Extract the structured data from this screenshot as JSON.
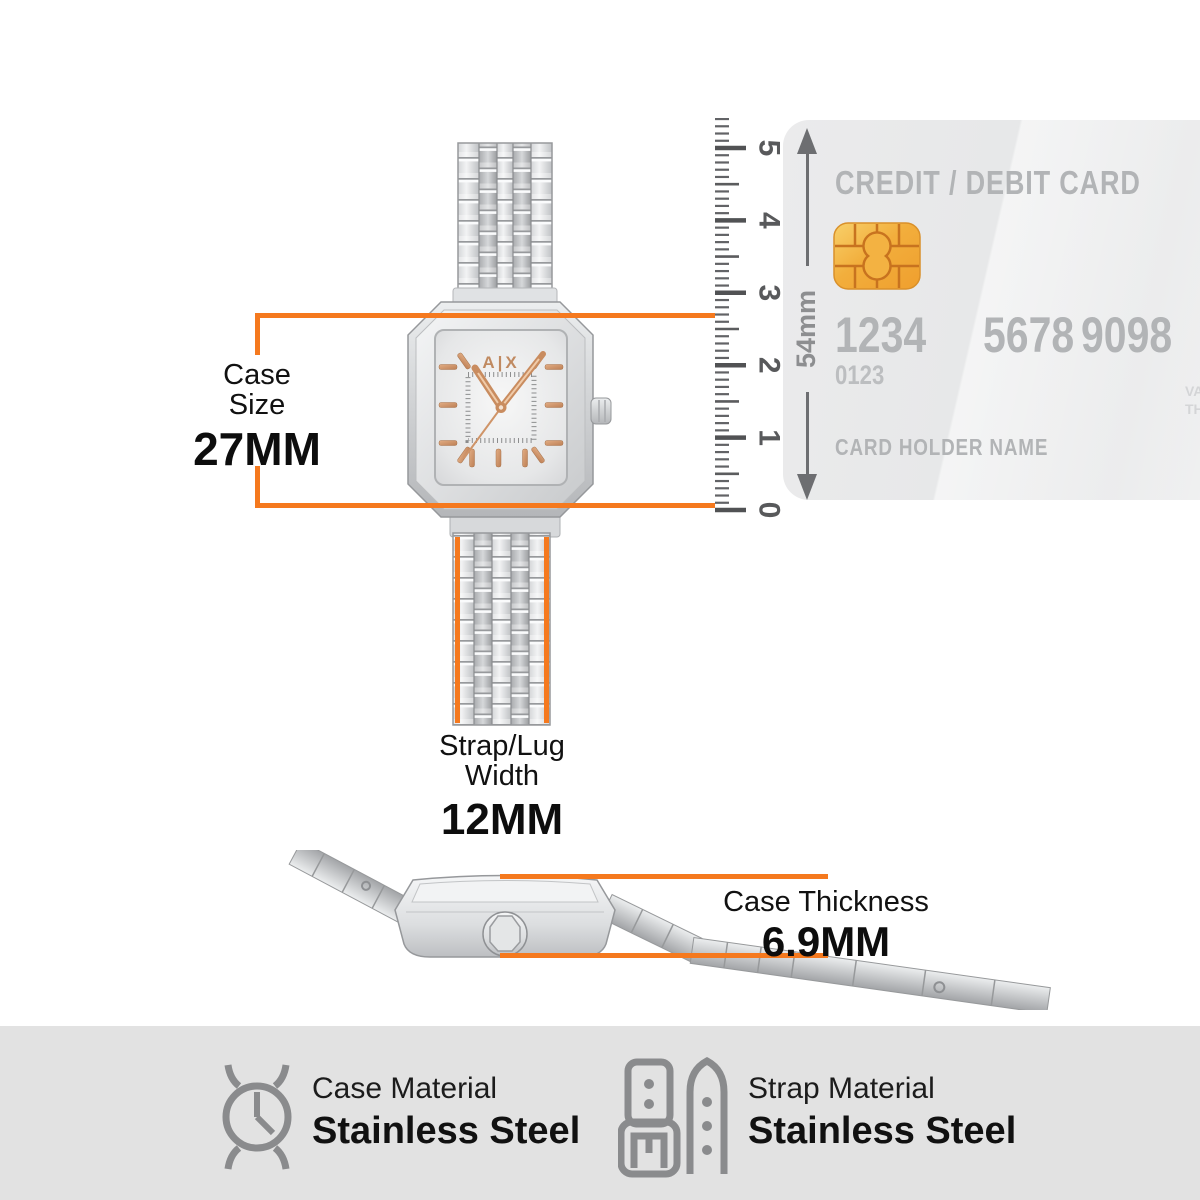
{
  "accent_color": "#F5791E",
  "measurements": {
    "case_size": {
      "label_line1": "Case",
      "label_line2": "Size",
      "value": "27MM"
    },
    "strap_width": {
      "label_line1": "Strap/Lug",
      "label_line2": "Width",
      "value": "12MM"
    },
    "case_thickness": {
      "label": "Case Thickness",
      "value": "6.9MM"
    }
  },
  "ruler": {
    "unit_labels": [
      "0",
      "1",
      "2",
      "3",
      "4",
      "5"
    ]
  },
  "card": {
    "title": "CREDIT / DEBIT CARD",
    "number_groups": [
      "1234",
      "5678",
      "9098"
    ],
    "sub_number": "0123",
    "holder_label": "CARD HOLDER NAME",
    "height_label": "54mm",
    "valid_line1": "VALID",
    "valid_line2": "THRU"
  },
  "watch": {
    "brand_logo": "A|X"
  },
  "materials": [
    {
      "label": "Case Material",
      "value": "Stainless Steel"
    },
    {
      "label": "Strap Material",
      "value": "Stainless Steel"
    }
  ]
}
